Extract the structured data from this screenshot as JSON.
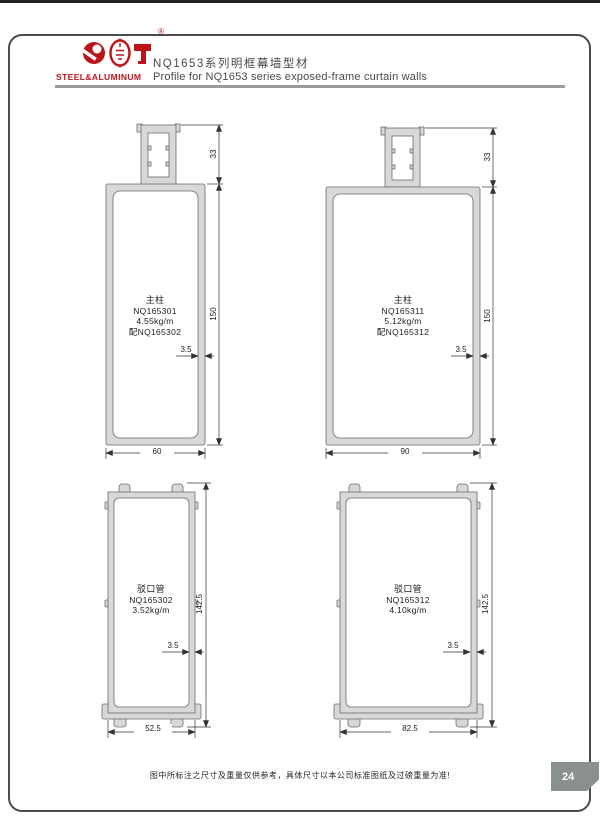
{
  "header": {
    "brand": "STEEL&ALUMINUM",
    "registered": "®",
    "title_cn": "NQ1653系列明框幕墙型材",
    "title_en": "Profile for NQ1653 series exposed-frame curtain walls"
  },
  "profiles": [
    {
      "name_cn": "主柱",
      "code": "NQ165301",
      "weight": "4.55kg/m",
      "paired": "配NQ165302",
      "dims": {
        "top": "33",
        "height": "150",
        "wall": "3.5",
        "width": "60"
      }
    },
    {
      "name_cn": "主柱",
      "code": "NQ165311",
      "weight": "5.12kg/m",
      "paired": "配NQ165312",
      "dims": {
        "top": "33",
        "height": "150",
        "wall": "3.5",
        "width": "90"
      }
    },
    {
      "name_cn": "驳口管",
      "code": "NQ165302",
      "weight": "3.52kg/m",
      "dims": {
        "height": "142.5",
        "wall": "3.5",
        "width": "52.5"
      }
    },
    {
      "name_cn": "驳口管",
      "code": "NQ165312",
      "weight": "4.10kg/m",
      "dims": {
        "height": "142.5",
        "wall": "3.5",
        "width": "82.5"
      }
    }
  ],
  "footer": {
    "note": "图中所标注之尺寸及重量仅供参考，具体尺寸以本公司标准图纸及过磅重量为准!",
    "page_number": "24"
  },
  "colors": {
    "brand_red": "#bb1519",
    "badge_gray": "#8a8f8f"
  }
}
